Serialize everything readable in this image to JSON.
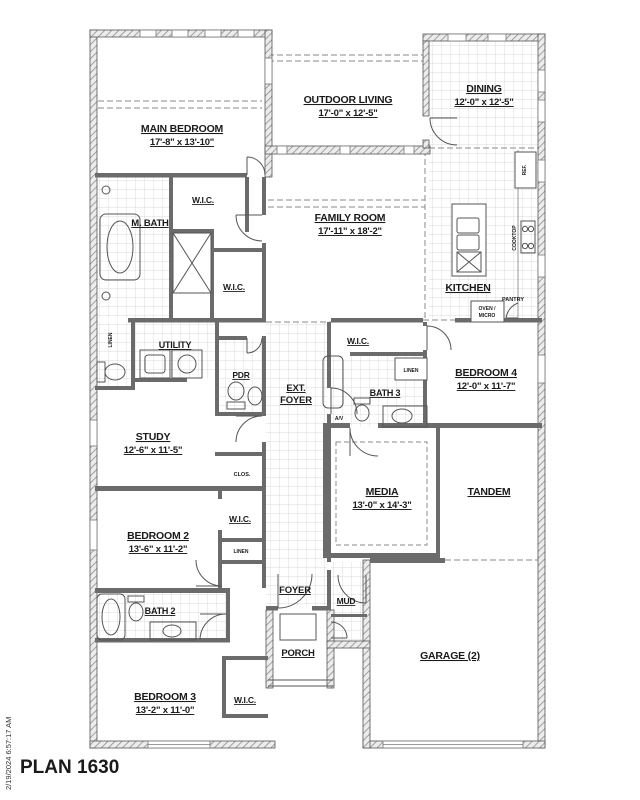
{
  "meta": {
    "plan_title": "PLAN 1630",
    "print_timestamp": "2/19/2024 6:57:17 AM"
  },
  "colors": {
    "interior_wall": "#6b6b6b",
    "exterior_wall_hatch": "#8d8d8d",
    "tile_line": "#cfcfcf",
    "text": "#1a1a1a"
  },
  "rooms": {
    "main_bedroom": {
      "name": "MAIN BEDROOM",
      "dims": "17'-8\" x 13'-10\""
    },
    "outdoor_living": {
      "name": "OUTDOOR LIVING",
      "dims": "17'-0\" x 12'-5\""
    },
    "dining": {
      "name": "DINING",
      "dims": "12'-0\" x 12'-5\""
    },
    "family_room": {
      "name": "FAMILY ROOM",
      "dims": "17'-11\" x 18'-2\""
    },
    "kitchen": {
      "name": "KITCHEN"
    },
    "m_bath": {
      "name": "M. BATH"
    },
    "wic_main_upper": {
      "name": "W.I.C."
    },
    "wic_main_lower": {
      "name": "W.I.C."
    },
    "utility": {
      "name": "UTILITY"
    },
    "powder": {
      "name": "PDR"
    },
    "ext_foyer": {
      "line1": "EXT.",
      "line2": "FOYER"
    },
    "study": {
      "name": "STUDY",
      "dims": "12'-6\" x 11'-5\""
    },
    "bath3": {
      "name": "BATH 3"
    },
    "wic_bed4": {
      "name": "W.I.C."
    },
    "bedroom4": {
      "name": "BEDROOM 4",
      "dims": "12'-0\" x 11'-7\""
    },
    "media": {
      "name": "MEDIA",
      "dims": "13'-0\" x 14'-3\""
    },
    "tandem": {
      "name": "TANDEM"
    },
    "bedroom2": {
      "name": "BEDROOM 2",
      "dims": "13'-6\" x 11'-2\""
    },
    "wic_bed2": {
      "name": "W.I.C."
    },
    "closet_study": {
      "name": "CLOS."
    },
    "bath2": {
      "name": "BATH 2"
    },
    "bedroom3": {
      "name": "BEDROOM 3",
      "dims": "13'-2\" x 11'-0\""
    },
    "wic_bed3": {
      "name": "W.I.C."
    },
    "foyer": {
      "name": "FOYER"
    },
    "porch": {
      "name": "PORCH"
    },
    "mud": {
      "name": "MUD"
    },
    "garage": {
      "name": "GARAGE (2)"
    }
  },
  "annotations": {
    "linen_hall": "LINEN",
    "linen_bath3": "LINEN",
    "linen_bed2": "LINEN",
    "av_closet": "A/V",
    "refrigerator": "REF.",
    "cooktop": "COOKTOP",
    "pantry": "PANTRY",
    "oven_line1": "OVEN /",
    "oven_line2": "MICRO"
  }
}
